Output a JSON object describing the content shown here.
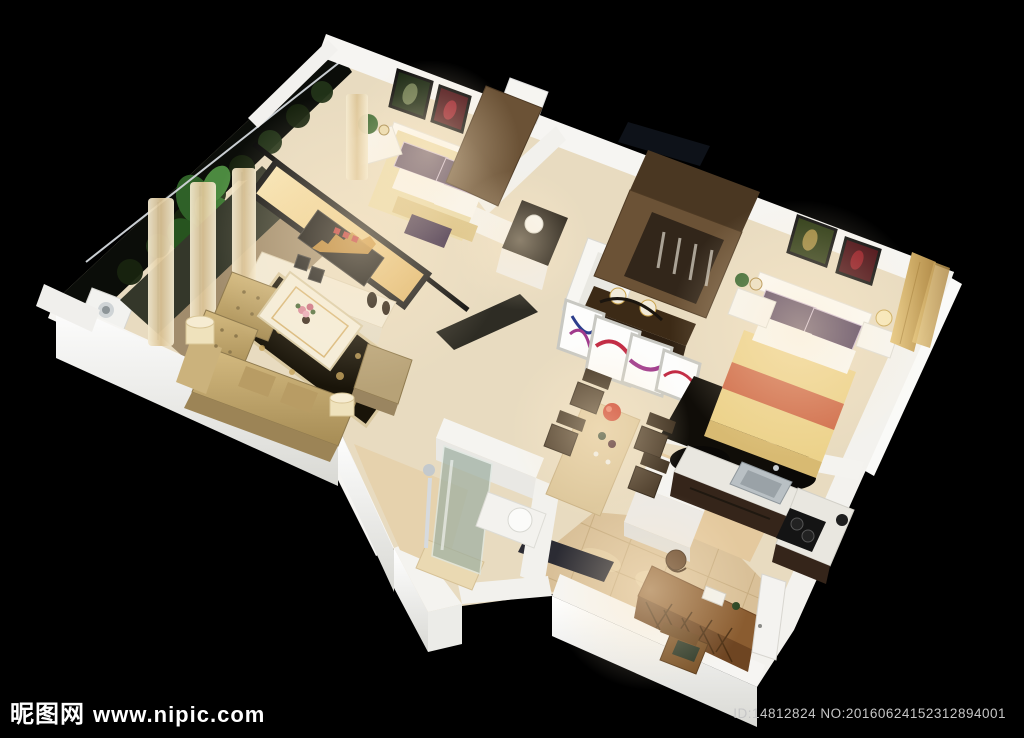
{
  "meta": {
    "description": "3D cutaway aerial render of a one-bedroom apartment floor plan on a black background"
  },
  "watermark": {
    "site_name": "昵图网",
    "site_url": "www.nipic.com",
    "id_line": "ID:14812824 NO:20160624152312894001"
  },
  "palette": {
    "background": "#000000",
    "wall_white": "#f5f4f1",
    "floor_cream": "#e8dbc0",
    "floor_tile_beige": "#d9c098",
    "wood_brown": "#6b5236",
    "sofa_gold": "#c3a96f",
    "bedspread_yellow": "#ecd28a",
    "bedspread_stripe_orange": "#cf6a48",
    "pillow_purple": "#4c3a58",
    "tv_wall_marble": "#f0d69e",
    "rug_dark": "#17130d",
    "curtain_beige": "#e7d7b4",
    "plant_green": "#3f7a35",
    "kitchen_cabinet_brown": "#35251a",
    "accent_red_bowl": "#c8311f"
  }
}
